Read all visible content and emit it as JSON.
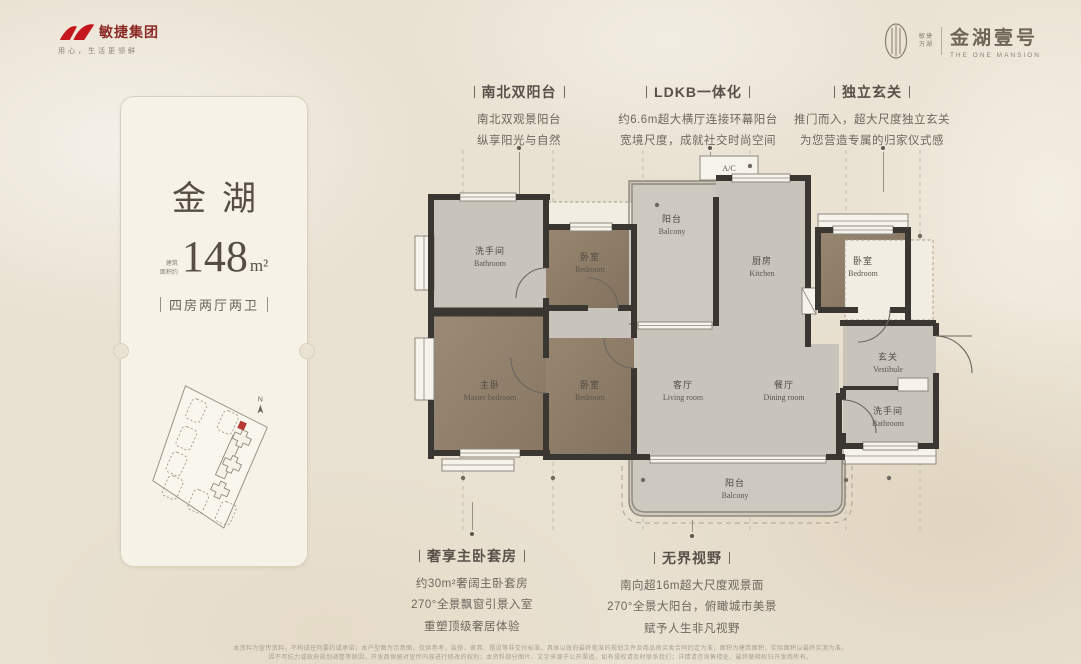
{
  "brand": {
    "group_name": "敏捷集团",
    "tagline": "用心，生活更领鲜",
    "project_small_line1": "敏捷",
    "project_small_line2": "万湖",
    "project_name": "金湖壹号",
    "project_name_en": "THE ONE MANSION"
  },
  "card": {
    "title": "金湖",
    "area_prefix_line1": "建筑",
    "area_prefix_line2": "面积约",
    "area_value": "148",
    "area_unit": "m²",
    "layout": "四房两厅两卫",
    "compass": "N"
  },
  "callouts": [
    {
      "title": "南北双阳台",
      "lines": [
        "南北双观景阳台",
        "纵享阳光与自然"
      ]
    },
    {
      "title": "LDKB一体化",
      "lines": [
        "约6.6m超大横厅连接环幕阳台",
        "宽境尺度，成就社交时尚空间"
      ]
    },
    {
      "title": "独立玄关",
      "lines": [
        "推门而入，超大尺度独立玄关",
        "为您营造专属的归家仪式感"
      ]
    },
    {
      "title": "奢享主卧套房",
      "lines": [
        "约30m²奢阔主卧套房",
        "270°全景飘窗引景入室",
        "重塑顶级奢居体验"
      ]
    },
    {
      "title": "无界视野",
      "lines": [
        "南向超16m超大尺度观景面",
        "270°全景大阳台，俯瞰城市美景",
        "赋予人生非凡视野"
      ]
    }
  ],
  "floorplan": {
    "ac_label": "A/C",
    "rooms": [
      {
        "zh": "洗手间",
        "en": "Bathroom"
      },
      {
        "zh": "卧室",
        "en": "Bedroom"
      },
      {
        "zh": "阳台",
        "en": "Balcony"
      },
      {
        "zh": "厨房",
        "en": "Kitchen"
      },
      {
        "zh": "卧室",
        "en": "Bedroom"
      },
      {
        "zh": "主卧",
        "en": "Master bedroom"
      },
      {
        "zh": "卧室",
        "en": "Bedroom"
      },
      {
        "zh": "客厅",
        "en": "Living room"
      },
      {
        "zh": "餐厅",
        "en": "Dining room"
      },
      {
        "zh": "玄关",
        "en": "Vestibule"
      },
      {
        "zh": "洗手间",
        "en": "Bathroom"
      },
      {
        "zh": "阳台",
        "en": "Balcony"
      }
    ]
  },
  "disclaimer": {
    "line1": "本资料为宣传资料，不构成任何要约或承诺；本户型图为示意图，仅供参考，装修、家具、摆设等非交付标准，具体以政府最终批准的规划文件及商品房买卖合同约定为准；面积为建筑面积，实际面积以最终实测为准。",
    "line2": "因不可抗力或政府规划调整等原因，开发商保留对宣传内容进行修改的权利；本资料部分图片、文字来源于公开渠道，如有侵权请及时联系我们；详情请咨询售楼处，最终解释权归开发商所有。"
  }
}
